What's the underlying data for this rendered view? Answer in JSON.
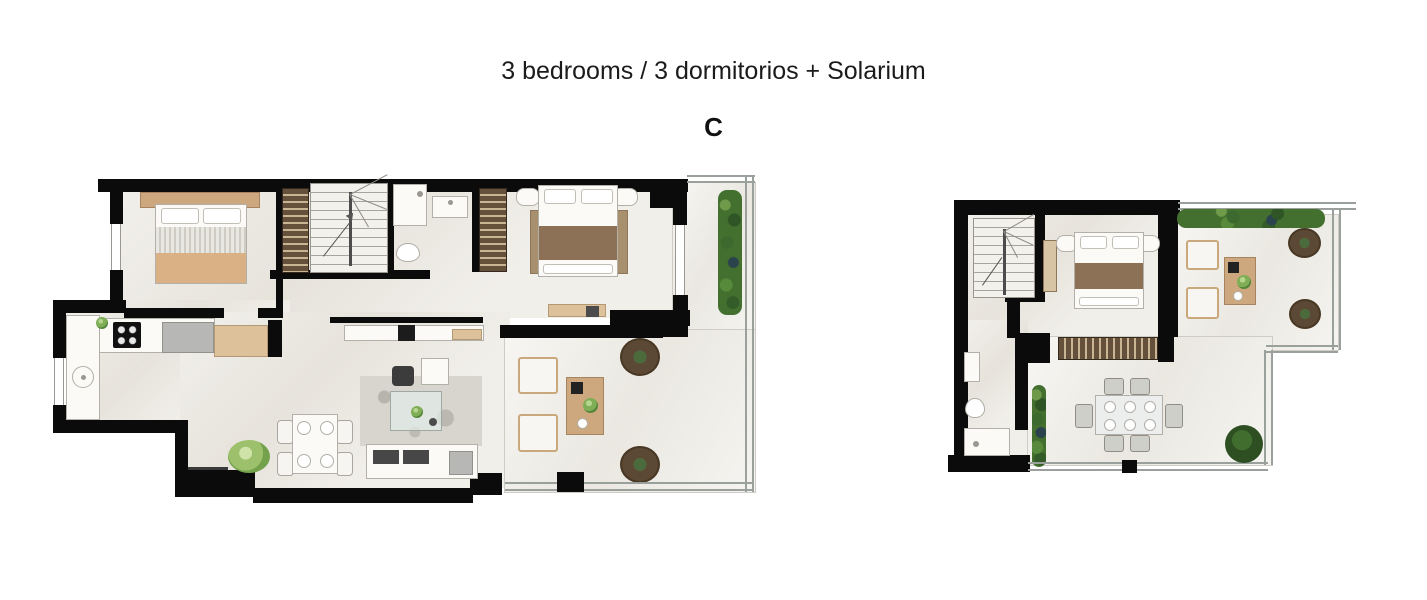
{
  "header": {
    "title": "3 bedrooms / 3 dormitorios + Solarium",
    "plan_label": "C"
  },
  "colors": {
    "background": "#ffffff",
    "wall": "#0b0b0b",
    "floor": "#ebe8e1",
    "terrace_floor": "#efede7",
    "wood": "#cda87e",
    "wardrobe_dark": "#64503b",
    "hedge_green": "#44702f",
    "round_rug_brown": "#5b4835",
    "bed_blanket_tan": "#d9b184",
    "bed_blanket_brown": "#8d7156",
    "title_text": "#1b1b1b"
  },
  "plans": [
    {
      "name": "main floor plan",
      "rooms": [
        "bedroom 1",
        "staircase",
        "bathroom",
        "bedroom 2",
        "kitchen",
        "living-dining room",
        "entry",
        "upper terrace",
        "lower terrace"
      ],
      "furniture": [
        "double bed with wood headboard",
        "wardrobe",
        "winder staircase",
        "shower",
        "washbasin",
        "toilet",
        "wardrobe",
        "double bed with nightstands",
        "desk with chair",
        "kitchen counter with hob, fridge and wood cabinet",
        "round kitchen sink",
        "dining table with 4 chairs",
        "potted plant",
        "area rug",
        "glass coffee table",
        "armchair",
        "side table",
        "sofa",
        "media console with TV",
        "2 sun loungers",
        "wood side table",
        "2 round rugs",
        "hedge planter",
        "glass railing"
      ]
    },
    {
      "name": "solarium floor plan",
      "rooms": [
        "staircase",
        "bedroom 3",
        "bathroom",
        "solarium terrace"
      ],
      "furniture": [
        "winder staircase",
        "double bed with nightstands",
        "runner rug",
        "wardrobe",
        "washbasin",
        "toilet",
        "shower",
        "vertical hedge planter",
        "top hedge planter",
        "2 sun loungers",
        "wood side table",
        "2 round rugs",
        "outdoor dining table with 6 chairs",
        "tree",
        "glass railing"
      ]
    }
  ]
}
